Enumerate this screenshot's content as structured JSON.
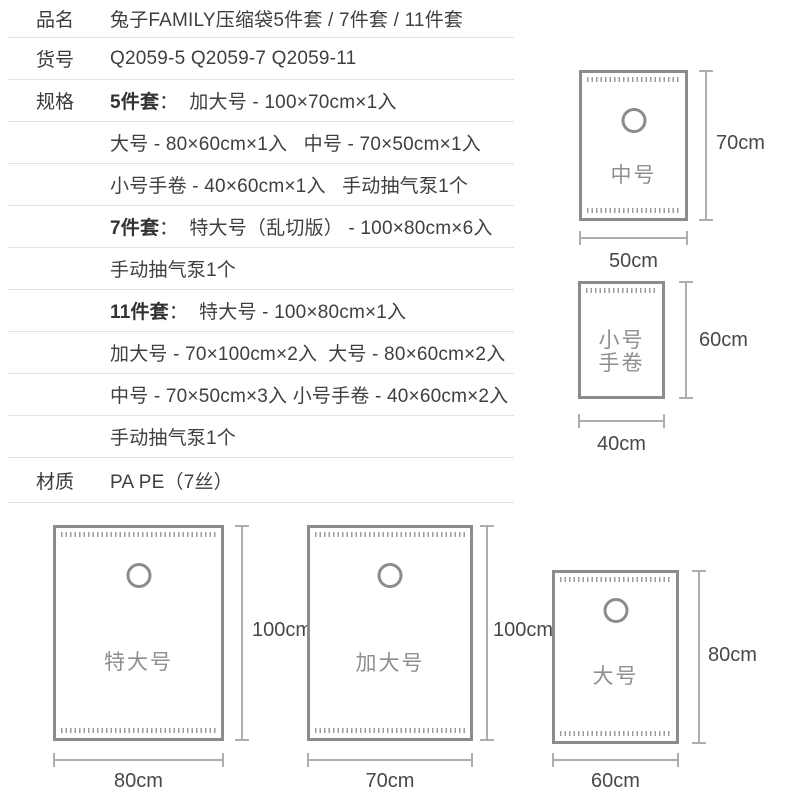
{
  "colors": {
    "background": "#ffffff",
    "spec_text": "#3f3f3f",
    "spec_bold_text": "#323232",
    "divider": "#e3e3e3",
    "bag_border": "#8c8c8c",
    "bag_label": "#8f8f8f",
    "dimension_line": "#adadad",
    "dimension_text": "#484848"
  },
  "spec_table": {
    "rows": [
      {
        "label": "品名",
        "bold": "",
        "text": "兔子FAMILY压缩袋5件套 / 7件套 / 11件套"
      },
      {
        "label": "货号",
        "bold": "",
        "text": "Q2059-5 Q2059-7 Q2059-11"
      },
      {
        "label": "规格",
        "bold": "5件套",
        "text": "：  加大号 - 100×70cm×1入"
      },
      {
        "label": "",
        "bold": "",
        "text": "大号 - 80×60cm×1入   中号 - 70×50cm×1入"
      },
      {
        "label": "",
        "bold": "",
        "text": "小号手卷 - 40×60cm×1入   手动抽气泵1个"
      },
      {
        "label": "",
        "bold": "7件套",
        "text": "：  特大号（乱切版） - 100×80cm×6入"
      },
      {
        "label": "",
        "bold": "",
        "text": "手动抽气泵1个"
      },
      {
        "label": "",
        "bold": "11件套",
        "text": "：  特大号 - 100×80cm×1入"
      },
      {
        "label": "",
        "bold": "",
        "text": "加大号 - 70×100cm×2入  大号 - 80×60cm×2入"
      },
      {
        "label": "",
        "bold": "",
        "text": "中号 - 70×50cm×3入 小号手卷 - 40×60cm×2入"
      },
      {
        "label": "",
        "bold": "",
        "text": "手动抽气泵1个"
      },
      {
        "label": "材质",
        "bold": "",
        "text": "PA PE（7丝）"
      }
    ]
  },
  "diagrams": [
    {
      "name": "中号",
      "lines": [
        "中号"
      ],
      "height": "70cm",
      "width": "50cm"
    },
    {
      "name": "小号手卷",
      "lines": [
        "小号",
        "手卷"
      ],
      "height": "60cm",
      "width": "40cm"
    },
    {
      "name": "特大号",
      "lines": [
        "特大号"
      ],
      "height": "100cm",
      "width": "80cm"
    },
    {
      "name": "加大号",
      "lines": [
        "加大号"
      ],
      "height": "100cm",
      "width": "70cm"
    },
    {
      "name": "大号",
      "lines": [
        "大号"
      ],
      "height": "80cm",
      "width": "60cm"
    }
  ]
}
